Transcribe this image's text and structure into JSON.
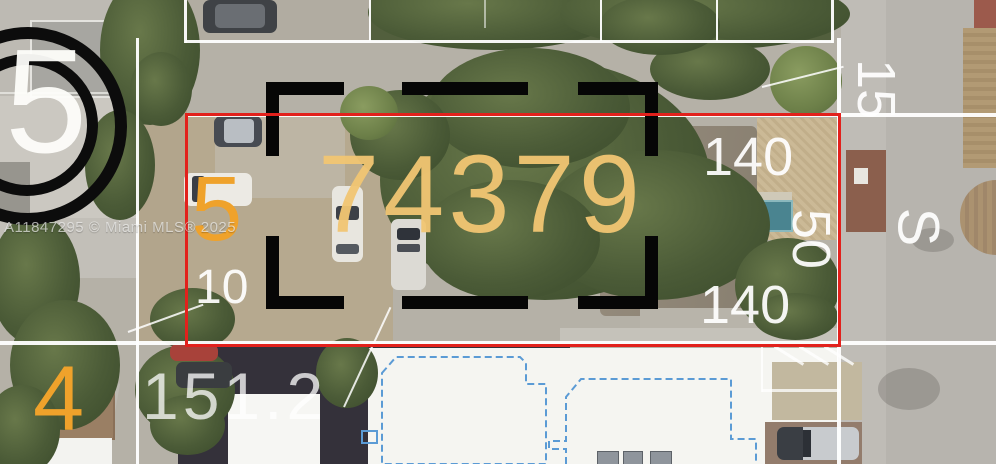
{
  "watermark": {
    "text": "A11847295 © Miami MLS® 2025"
  },
  "overlay": {
    "parcel_number": "74379",
    "lot_number_circled": "5",
    "lot_number_left": "5",
    "lot_number_bottom_left": "4",
    "street_letter": "S",
    "dims": {
      "top": "140",
      "right": "50",
      "bottom": "140",
      "left": "10",
      "lower": "151.2",
      "street_top": "15"
    }
  },
  "colors": {
    "boundary_red": "#e2211c",
    "setback_dash_black": "#060606",
    "structure_outline_blue": "#5b9bd5",
    "lot_number_orange": "#efa22b",
    "parcel_number_tan": "#f2c673",
    "dimension_label_white": "#ffffff"
  }
}
